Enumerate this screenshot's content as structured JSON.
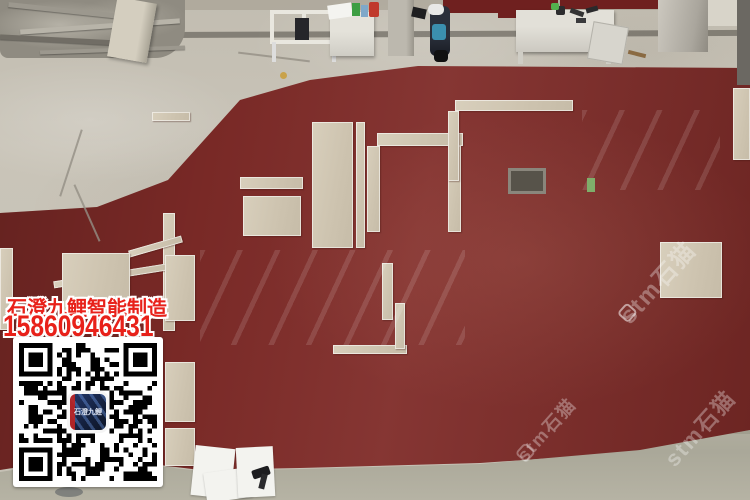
{
  "branding": {
    "company_name": "石澄九鲤智能制造",
    "phone_number": "15860946431",
    "text_color": "#e8211a"
  },
  "qr_code": {
    "center_logo_text": "石澄九鲤",
    "foreground": "#000000",
    "background": "#ffffff",
    "logo_navy": "#16233f",
    "logo_red": "#be2323"
  },
  "watermark": {
    "brand_text": "stm石猫",
    "color": "#ffffff"
  },
  "scene_colors": {
    "floor_red": "#7f2b28",
    "concrete_gray": "#c6c1b5",
    "tile_beige": "#cfc5b1",
    "tile_gloss_white": "#e6eae9"
  }
}
